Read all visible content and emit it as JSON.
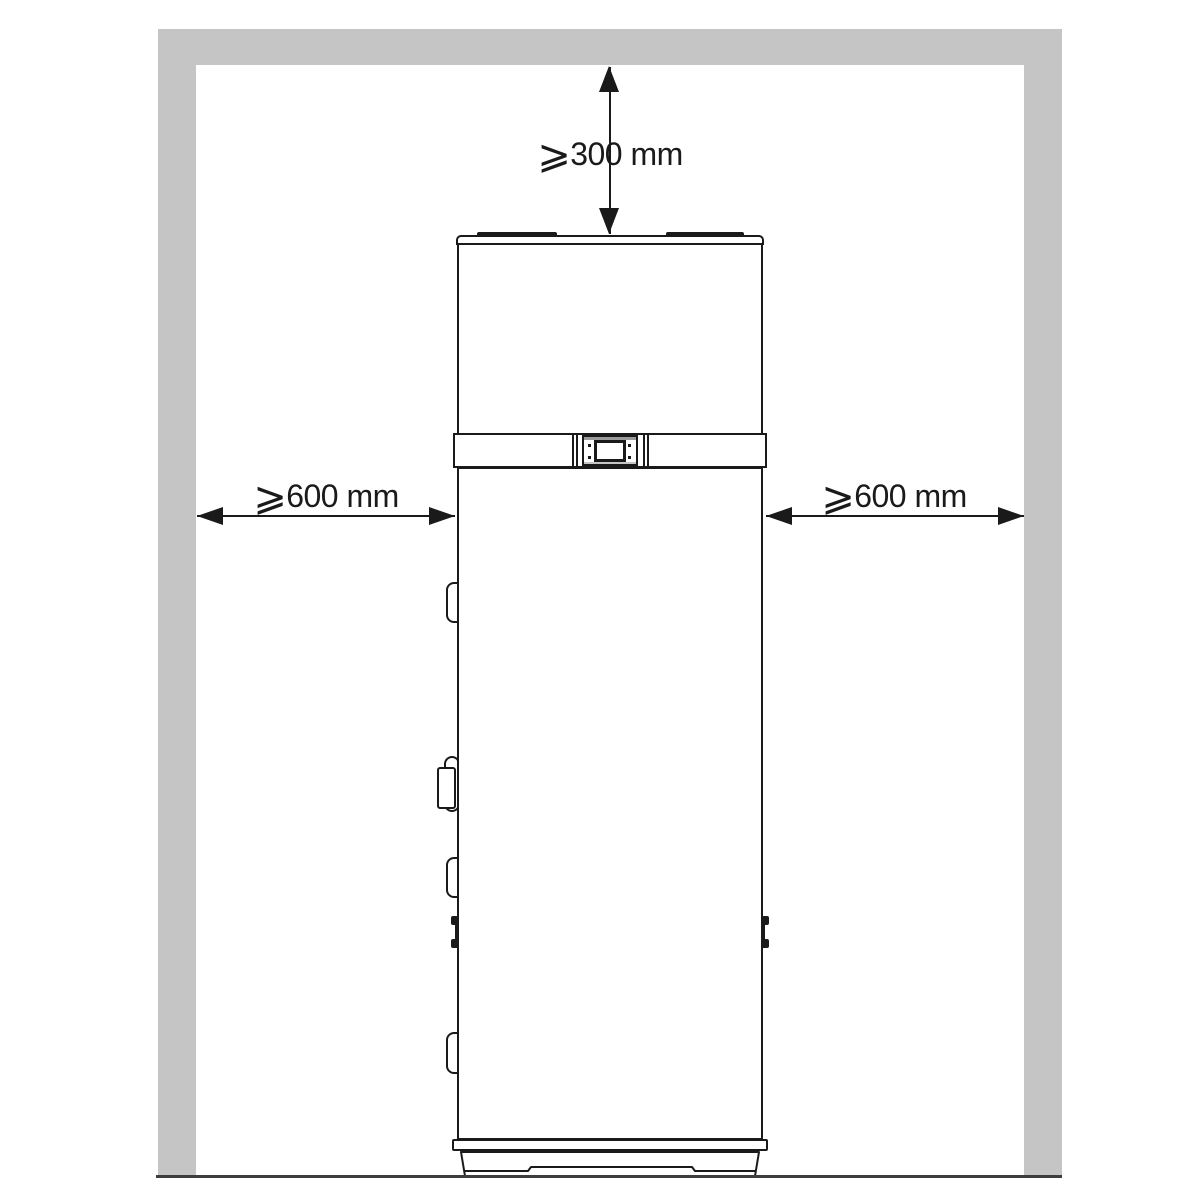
{
  "figure": {
    "kind": "installation-clearance-diagram",
    "unit": "mm",
    "labels": {
      "clearance_top": {
        "symbol": "⩾",
        "text": "300 mm"
      },
      "clearance_left": {
        "symbol": "⩾",
        "text": "600 mm"
      },
      "clearance_right": {
        "symbol": "⩾",
        "text": "600 mm"
      }
    },
    "clearances_mm": {
      "top_min": 300,
      "left_min": 600,
      "right_min": 600
    },
    "colors": {
      "wall": "#c5c5c5",
      "outline": "#1a1a1a",
      "floor": "#3d3d3d"
    }
  }
}
